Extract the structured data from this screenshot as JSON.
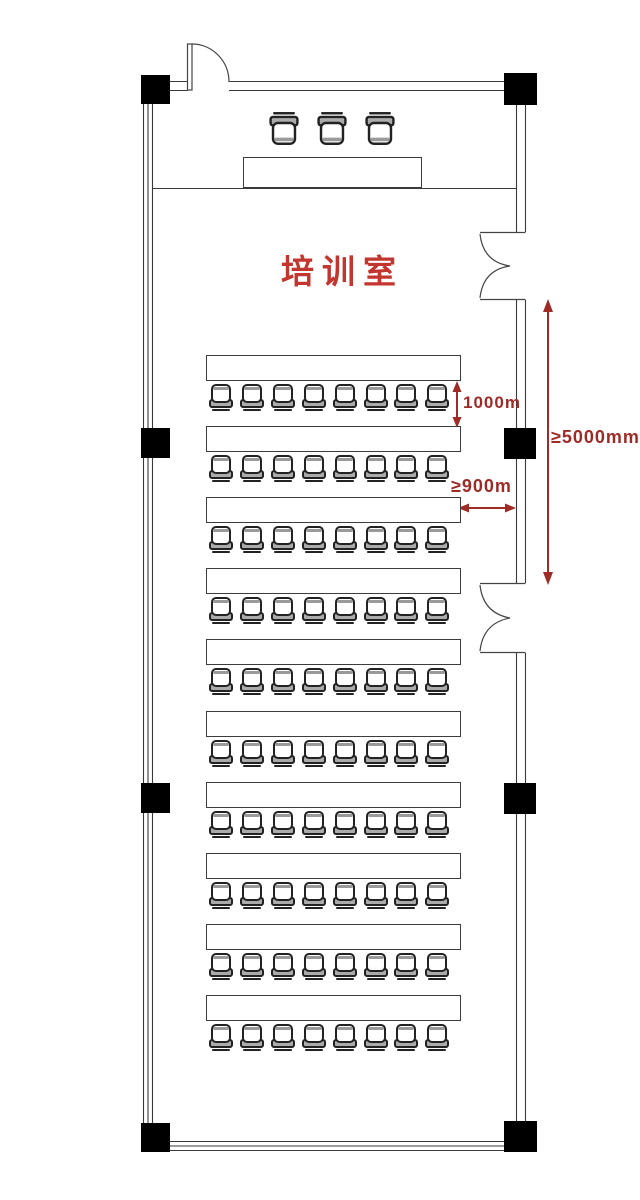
{
  "room": {
    "title": "培训室"
  },
  "annotations": {
    "row_depth": "1000m",
    "aisle_width": "≥900m",
    "exit_distance": "≥5000mm"
  },
  "seating": {
    "rows": 10,
    "chairs_per_row": 8,
    "podium_chairs": 3
  },
  "colors": {
    "dimension_red": "#9e2b26",
    "title_red": "#c3362f",
    "wall_line": "#3a3a3a",
    "furniture_line": "#222222",
    "column_black": "#000000"
  }
}
